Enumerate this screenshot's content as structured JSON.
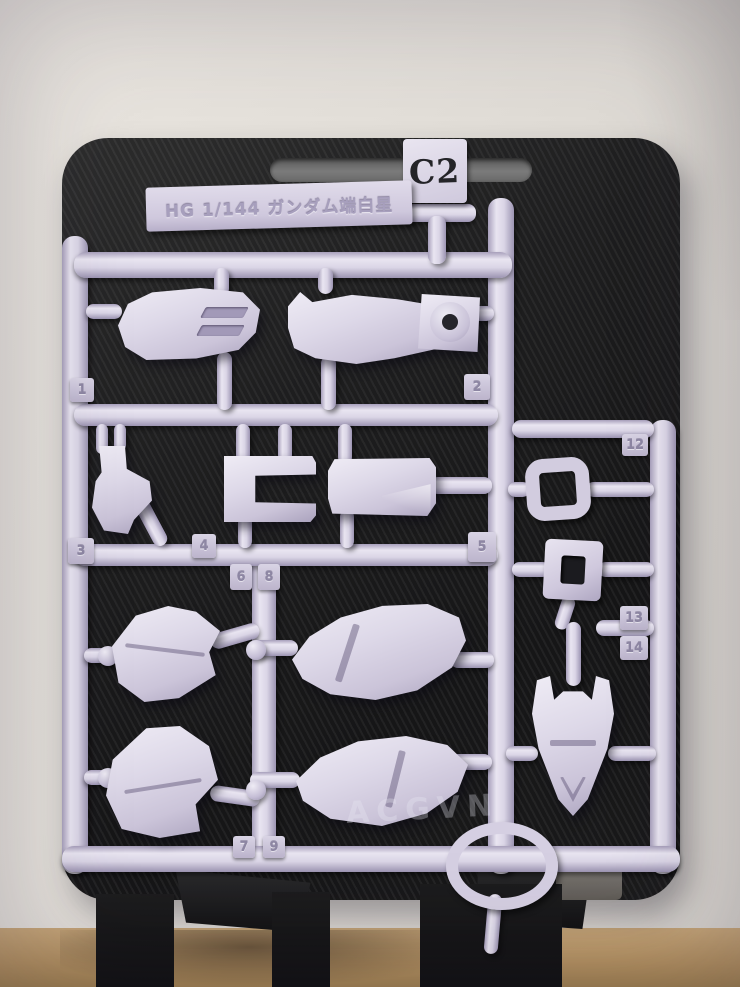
{
  "photo": {
    "subject": "Gunpla model kit runner C2 on black display stand",
    "runner": {
      "gate_code": "C2",
      "label_text": "HG 1/144 ガンダム端白星",
      "plastic_color_hex": "#d6d0e3",
      "part_numbers_visible": [
        "1",
        "2",
        "3",
        "4",
        "5",
        "6",
        "7",
        "8",
        "9",
        "12",
        "13",
        "14"
      ]
    },
    "tags": {
      "t1": "1",
      "t2": "2",
      "t3": "3",
      "t4": "4",
      "t5": "5",
      "t6": "6",
      "t7": "7",
      "t8": "8",
      "t9": "9",
      "t12": "12",
      "t13": "13",
      "t14": "14"
    },
    "watermark": "ACGVN",
    "background": {
      "board_color_hex": "#1b1b1c",
      "wall_color_hex": "#e3dfd9",
      "floor_color_hex": "#b3905f"
    }
  }
}
